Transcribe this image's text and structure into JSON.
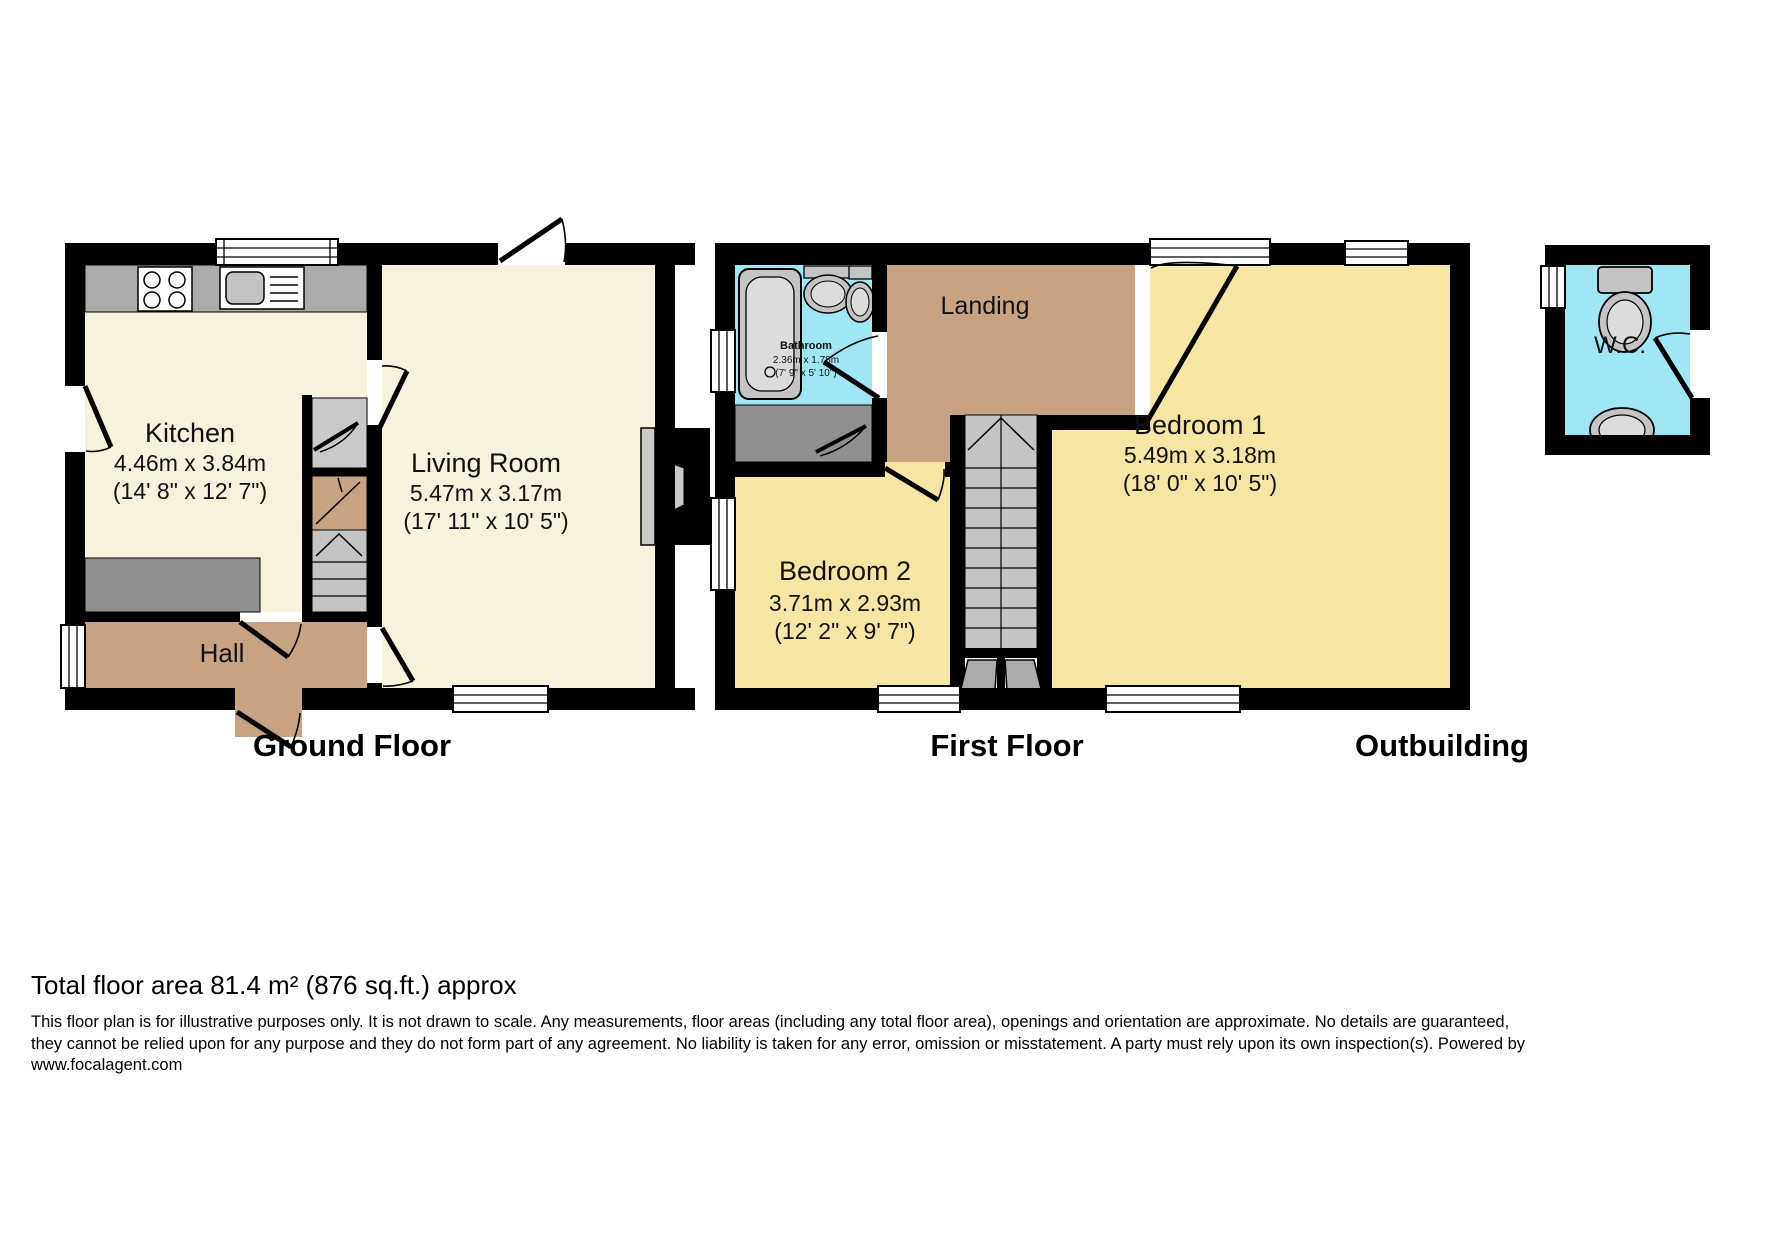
{
  "ground_floor": {
    "label": "Ground Floor",
    "kitchen": {
      "name": "Kitchen",
      "metric": "4.46m x 3.84m",
      "imperial": "(14' 8\" x 12' 7\")"
    },
    "living_room": {
      "name": "Living Room",
      "metric": "5.47m x 3.17m",
      "imperial": "(17' 11\" x 10' 5\")"
    },
    "hall": {
      "name": "Hall"
    }
  },
  "first_floor": {
    "label": "First Floor",
    "bathroom": {
      "name": "Bathroom",
      "metric": "2.36m x 1.78m",
      "imperial": "(7' 9\" x 5' 10\")"
    },
    "landing": {
      "name": "Landing"
    },
    "bedroom1": {
      "name": "Bedroom 1",
      "metric": "5.49m x 3.18m",
      "imperial": "(18' 0\" x 10' 5\")"
    },
    "bedroom2": {
      "name": "Bedroom 2",
      "metric": "3.71m x 2.93m",
      "imperial": "(12' 2\" x 9' 7\")"
    }
  },
  "outbuilding": {
    "label": "Outbuilding",
    "wc": {
      "name": "W.C."
    }
  },
  "footer": {
    "total_area": "Total floor area 81.4 m² (876 sq.ft.) approx",
    "disclaimer_line1": "This floor plan is for illustrative purposes only. It is not drawn to scale. Any measurements, floor areas (including any total floor area), openings and orientation are approximate. No details are guaranteed,",
    "disclaimer_line2": "they cannot be relied upon for any purpose and they do not form part of any agreement. No liability is taken for any error, omission or misstatement. A party must rely upon its own inspection(s). Powered by",
    "disclaimer_line3": "www.focalagent.com"
  },
  "colors": {
    "wall": "#000000",
    "ground_room": "#F7F2DB",
    "first_room": "#F6E5A3",
    "hall_landing": "#C7A384",
    "wet_room": "#9FE7F5",
    "counter_gray": "#ABABAB",
    "fixture_gray": "#C4C4C4",
    "dark_gray": "#8F8F8F"
  }
}
